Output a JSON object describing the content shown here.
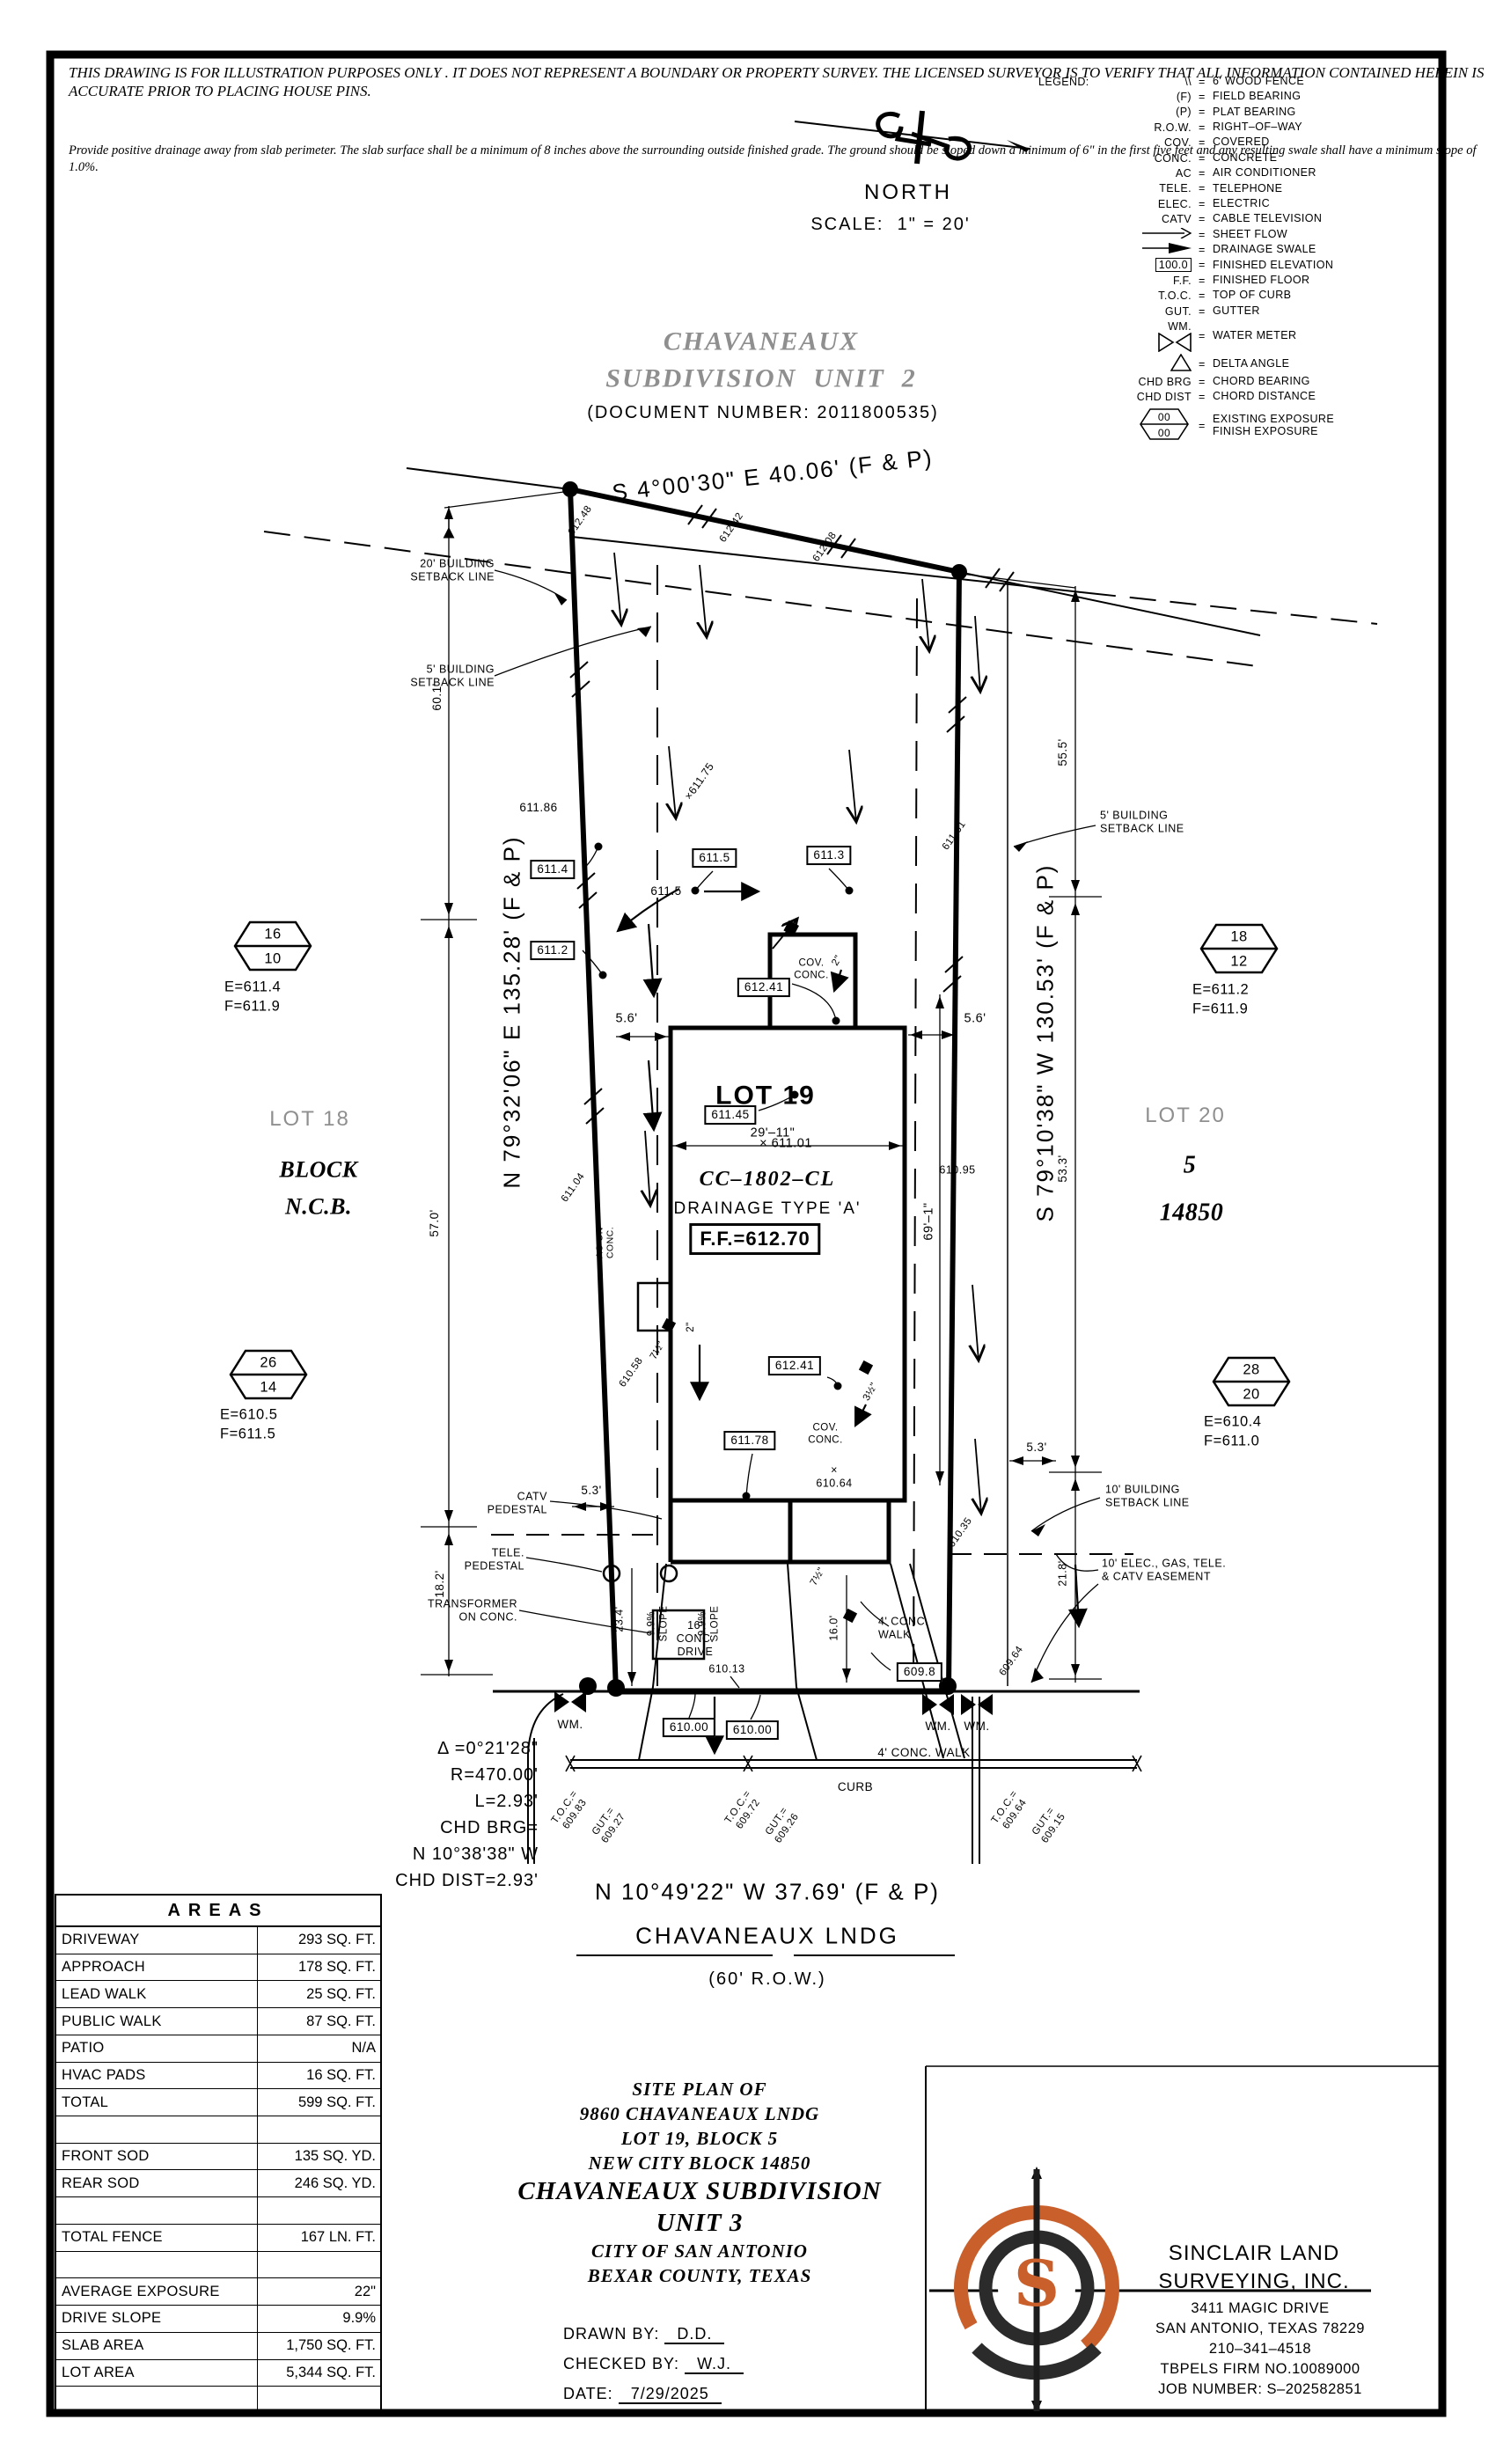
{
  "disclaimer": {
    "para1": "THIS DRAWING IS FOR ILLUSTRATION PURPOSES ONLY . IT DOES\nNOT REPRESENT A BOUNDARY OR PROPERTY SURVEY. THE\nLICENSED SURVEYOR IS TO VERIFY THAT ALL INFORMATION\nCONTAINED HEREIN IS ACCURATE PRIOR TO PLACING HOUSE PINS.",
    "para2": "Provide positive drainage away from slab perimeter. The slab surface shall be a\nminimum of 8 inches above the surrounding outside finished grade. The ground should be\nsloped down a minimum of 6\" in the first five feet and any resulting swale shall have a\nminimum slope of 1.0%."
  },
  "compass": {
    "north": "NORTH",
    "scale": "SCALE:  1\" = 20'"
  },
  "legend": {
    "title": "LEGEND:",
    "sep": "=",
    "rows": [
      {
        "sym": "\\\\",
        "text": "6' WOOD FENCE"
      },
      {
        "sym": "(F)",
        "text": "FIELD BEARING"
      },
      {
        "sym": "(P)",
        "text": "PLAT BEARING"
      },
      {
        "sym": "R.O.W.",
        "text": "RIGHT–OF–WAY"
      },
      {
        "sym": "COV.",
        "text": "COVERED"
      },
      {
        "sym": "CONC.",
        "text": "CONCRETE"
      },
      {
        "sym": "AC",
        "text": "AIR CONDITIONER"
      },
      {
        "sym": "TELE.",
        "text": "TELEPHONE"
      },
      {
        "sym": "ELEC.",
        "text": "ELECTRIC"
      },
      {
        "sym": "CATV",
        "text": "CABLE TELEVISION"
      },
      {
        "sym": "",
        "text": "SHEET FLOW"
      },
      {
        "sym": "",
        "text": "DRAINAGE SWALE"
      },
      {
        "sym": "100.0",
        "text": "FINISHED ELEVATION"
      },
      {
        "sym": "F.F.",
        "text": "FINISHED FLOOR"
      },
      {
        "sym": "T.O.C.",
        "text": "TOP OF CURB"
      },
      {
        "sym": "GUT.",
        "text": "GUTTER"
      },
      {
        "sym": "WM.",
        "text": "WATER METER"
      },
      {
        "sym": "",
        "text": "DELTA ANGLE"
      },
      {
        "sym": "CHD BRG",
        "text": "CHORD BEARING"
      },
      {
        "sym": "CHD DIST",
        "text": "CHORD DISTANCE"
      },
      {
        "sym": "00\n00",
        "text": "EXISTING EXPOSURE\nFINISH EXPOSURE"
      }
    ]
  },
  "subdivision_top": {
    "title1": "CHAVANEAUX",
    "title2": "SUBDIVISION  UNIT  2",
    "doc": "(DOCUMENT NUMBER: 2011800535)"
  },
  "bearings": {
    "top": "S 4°00'30\" E 40.06' (F & P)",
    "left": "N 79°32'06\" E 135.28' (F & P)",
    "right": "S 79°10'38\" W 130.53' (F & P)",
    "street": "N 10°49'22\" W 37.69' (F & P)"
  },
  "street": {
    "name": "CHAVANEAUX LNDG",
    "row": "(60' R.O.W.)",
    "walk": "4' CONC. WALK",
    "curb": "CURB"
  },
  "lot19": {
    "name": "LOT 19",
    "spot": "× 611.01",
    "plan": "CC–1802–CL",
    "drainage": "DRAINAGE TYPE 'A'",
    "ff": "F.F.=612.70"
  },
  "neighbors": {
    "lot18": "LOT 18",
    "block": "BLOCK",
    "ncb": "N.C.B.",
    "lot20": "LOT 20",
    "blk5": "5",
    "ncb_num": "14850"
  },
  "hexes": {
    "lt": {
      "a": "16",
      "b": "10",
      "e": "E=611.4",
      "f": "F=611.9"
    },
    "rt": {
      "a": "18",
      "b": "12",
      "e": "E=611.2",
      "f": "F=611.9"
    },
    "lm": {
      "a": "26",
      "b": "14",
      "e": "E=610.5",
      "f": "F=611.5"
    },
    "rm": {
      "a": "28",
      "b": "20",
      "e": "E=610.4",
      "f": "F=611.0"
    }
  },
  "setbacks": {
    "s20": "20' BUILDING\nSETBACK LINE",
    "s5l": "5' BUILDING\nSETBACK LINE",
    "s5r": "5' BUILDING\nSETBACK LINE",
    "s10": "10' BUILDING\nSETBACK LINE",
    "easement": "10' ELEC., GAS, TELE.\n& CATV EASEMENT"
  },
  "utilities": {
    "catv": "CATV\nPEDESTAL",
    "tele": "TELE.\nPEDESTAL",
    "transformer": "TRANSFORMER\nON CONC.",
    "ac": "AC ON\nCONC.",
    "cov1": "COV.\nCONC.",
    "cov2": "COV.\nCONC.",
    "wm1": "WM.",
    "wm2": "WM.",
    "wm3": "WM.",
    "drive": "16'\nCONC.\nDRIVE",
    "slope1": "9.9%\nSLOPE",
    "slope2": "9.9%\nSLOPE",
    "leadwalk": "4' CONC.\nWALK"
  },
  "curve": {
    "l1": "Δ =0°21'28\"",
    "l2": "R=470.00'",
    "l3": "L=2.93'",
    "l4": "CHD BRG=",
    "l5": "N 10°38'38\" W",
    "l6": "CHD DIST=2.93'"
  },
  "dims": {
    "d60_1": "60.1'",
    "d57_0": "57.0'",
    "d18_2": "18.2'",
    "d55_5": "55.5'",
    "d53_3": "53.3'",
    "d21_8": "21.8'",
    "d23_4": "23.4'",
    "d16_0": "16.0'",
    "d5_6a": "5.6'",
    "d5_6b": "5.6'",
    "d5_3a": "5.3'",
    "d5_3b": "5.3'",
    "d69_1": "69'–1\"",
    "d29_11": "29'–11\"",
    "d7_5a": "7½\"",
    "d7_5b": "7½\"",
    "d3_5": "3½\"",
    "d2a": "2\"",
    "d2b": "2\""
  },
  "elev": {
    "e612_48": "612.48",
    "e612_42": "612.42",
    "e612_08": "612.08",
    "e611_86": "611.86",
    "b611_4": "611.4",
    "b611_5": "611.5",
    "p611_5": "611.5",
    "b611_3": "611.3",
    "b611_2": "611.2",
    "x611_75": "×611.75",
    "e611_61": "611.61",
    "e611_04": "611.04",
    "b612_41a": "612.41",
    "b611_45": "611.45",
    "b612_41b": "612.41",
    "b611_78": "611.78",
    "e610_58": "610.58",
    "e610_95": "610.95",
    "x610_64": "×\n610.64",
    "e610_35": "610.35",
    "e610_13": "610.13",
    "b609_8": "609.8",
    "e609_64": "609.64",
    "b610_00a": "610.00",
    "b610_00b": "610.00"
  },
  "toc": {
    "t1": "T.O.C.=\n609.83",
    "g1": "GUT.=\n609.27",
    "t2": "T.O.C.=\n609.72",
    "g2": "GUT.=\n609.26",
    "t3": "T.O.C.=\n609.64",
    "g3": "GUT.=\n609.15"
  },
  "areas_table": {
    "title": "AREAS",
    "rows": [
      {
        "label": "DRIVEWAY",
        "value": "293 SQ. FT."
      },
      {
        "label": "APPROACH",
        "value": "178 SQ. FT."
      },
      {
        "label": "LEAD WALK",
        "value": "25 SQ. FT."
      },
      {
        "label": "PUBLIC WALK",
        "value": "87 SQ. FT."
      },
      {
        "label": "PATIO",
        "value": "N/A"
      },
      {
        "label": "HVAC PADS",
        "value": "16 SQ. FT."
      },
      {
        "label": "TOTAL",
        "value": "599 SQ. FT."
      },
      {
        "label": "",
        "value": ""
      },
      {
        "label": "FRONT SOD",
        "value": "135 SQ. YD."
      },
      {
        "label": "REAR SOD",
        "value": "246 SQ. YD."
      },
      {
        "label": "",
        "value": ""
      },
      {
        "label": "TOTAL FENCE",
        "value": "167 LN. FT."
      },
      {
        "label": "",
        "value": ""
      },
      {
        "label": "AVERAGE EXPOSURE",
        "value": "22\""
      },
      {
        "label": "DRIVE SLOPE",
        "value": "9.9%"
      },
      {
        "label": "SLAB AREA",
        "value": "1,750 SQ. FT."
      },
      {
        "label": "LOT AREA",
        "value": "5,344 SQ. FT."
      },
      {
        "label": "",
        "value": ""
      }
    ]
  },
  "title_block": {
    "l1": "SITE PLAN OF",
    "l2": "9860 CHAVANEAUX LNDG",
    "l3": "LOT 19, BLOCK 5",
    "l4": "NEW CITY BLOCK 14850",
    "l5": "CHAVANEAUX SUBDIVISION",
    "l6": "UNIT 3",
    "l7": "CITY OF SAN ANTONIO",
    "l8": "BEXAR COUNTY, TEXAS",
    "drawn_label": "DRAWN BY:",
    "drawn": "D.D.",
    "checked_label": "CHECKED BY:",
    "checked": "W.J.",
    "date_label": "DATE:",
    "date": "7/29/2025"
  },
  "firm": {
    "n1": "SINCLAIR LAND",
    "n2": "SURVEYING, INC.",
    "a1": "3411 MAGIC DRIVE",
    "a2": "SAN ANTONIO, TEXAS 78229",
    "a3": "210–341–4518",
    "a4": "TBPELS FIRM NO.10089000",
    "a5": "JOB NUMBER: S–202582851"
  },
  "colors": {
    "accent_orange": "#c95f2b",
    "gray_text": "#8f8f8f"
  }
}
